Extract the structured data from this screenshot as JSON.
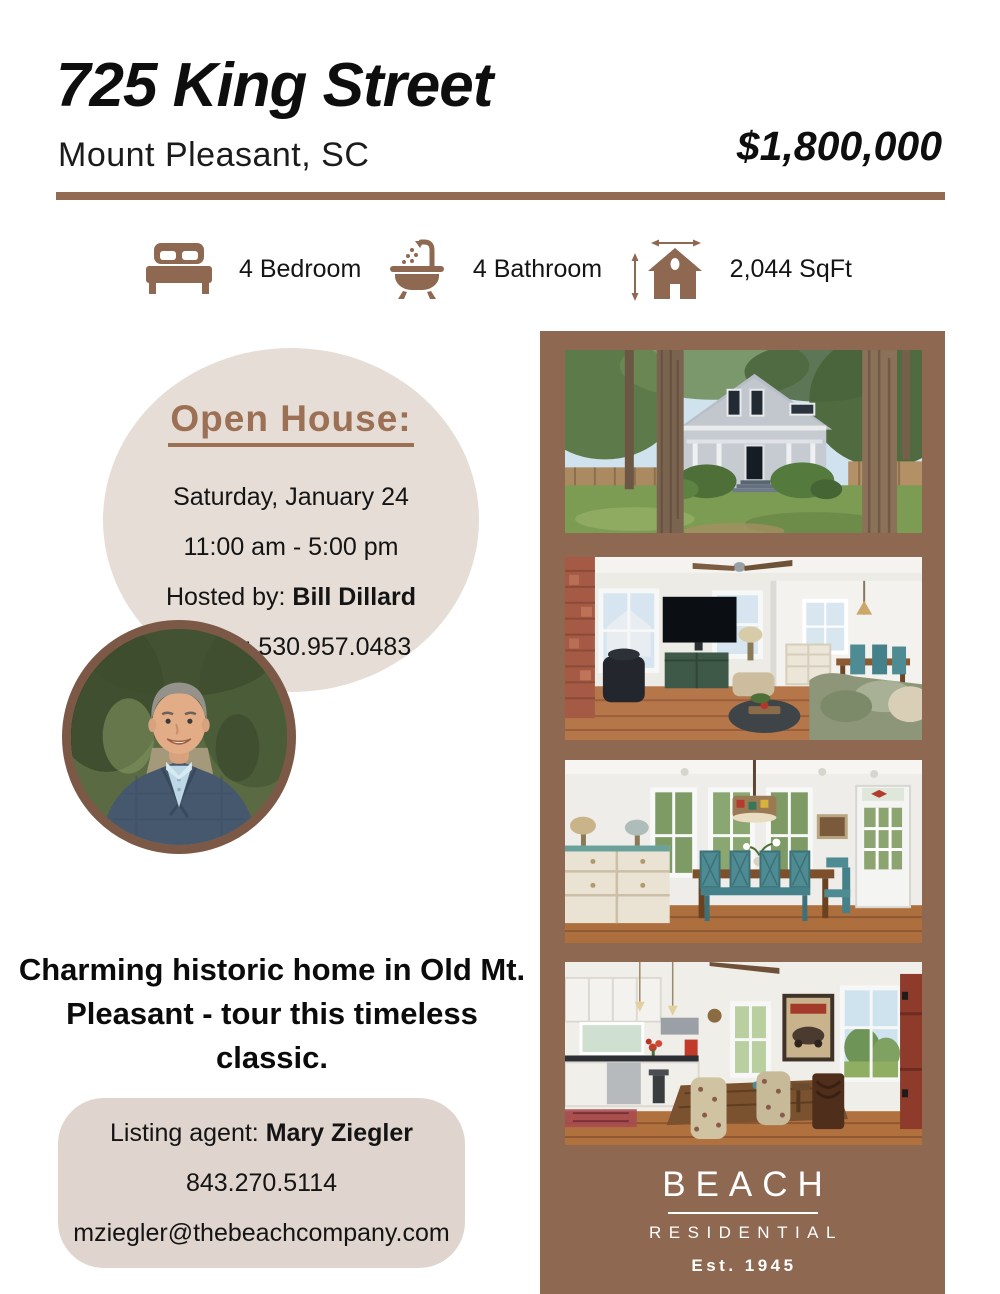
{
  "header": {
    "title": "725 King Street",
    "subtitle": "Mount Pleasant, SC",
    "price": "$1,800,000"
  },
  "features": [
    {
      "icon": "bed-icon",
      "label": "4 Bedroom"
    },
    {
      "icon": "bathtub-icon",
      "label": "4 Bathroom"
    },
    {
      "icon": "sqft-house-icon",
      "label": "2,044 SqFt"
    }
  ],
  "open_house": {
    "heading": "Open House:",
    "date": "Saturday, January 24",
    "time": "11:00 am - 5:00 pm",
    "hosted_by_label": "Hosted by: ",
    "host_name": "Bill Dillard",
    "mobile_label": "Mobile: ",
    "mobile_number": "530.957.0483"
  },
  "tagline": "Charming historic home in Old Mt. Pleasant - tour this timeless classic.",
  "listing_agent": {
    "label": "Listing agent: ",
    "name": "Mary Ziegler",
    "phone": "843.270.5114",
    "email": "mziegler@thebeachcompany.com"
  },
  "brand": {
    "name": "BEACH",
    "division": "RESIDENTIAL",
    "established": "Est. 1945"
  },
  "photos": [
    {
      "id": "exterior",
      "alt": "Gray two-story historic house with black front door, big trees and green lawn"
    },
    {
      "id": "living-room",
      "alt": "Living room with brick chimney, wall-mounted TV, ceiling fan, green cabinet and sage sofa"
    },
    {
      "id": "dining-room",
      "alt": "Dining room with white dresser, wood table, teal chairs, three windows and glass door"
    },
    {
      "id": "kitchen",
      "alt": "Kitchen breakfast area with white cabinets, wood table, floral chairs and red door"
    }
  ],
  "colors": {
    "brown": "#8F6851",
    "heading_brown": "#9C7055",
    "beige_circle": "#E5DDD6",
    "beige_box": "#DFD5CE",
    "text": "#141414",
    "logo_text": "#FFFFFF"
  }
}
